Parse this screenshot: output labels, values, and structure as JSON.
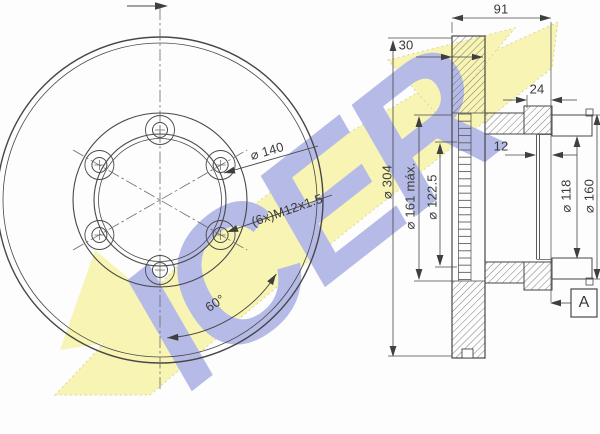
{
  "watermark": {
    "brand_text": "ICER",
    "yellow": "#f8f4b4",
    "blue": "#b5bbe6"
  },
  "front_view": {
    "bolt_circle_dia": "⌀ 140",
    "thread_spec": "(6x)M12x1.5",
    "bolt_angle": "60°"
  },
  "section_view": {
    "overall_width": "91",
    "disc_thickness": "30",
    "flange_depth": "24",
    "pilot_depth": "12",
    "outer_dia": "⌀ 304",
    "max_dia": "⌀ 161 máx.",
    "pilot_dia": "⌀ 122.5",
    "drum_inner_dia": "⌀ 118",
    "drum_outer_dia": "⌀ 160",
    "detail_label": "A"
  },
  "colors": {
    "line": "#474747",
    "dim_text": "#3a3a3a",
    "background": "#fdfdfd"
  }
}
